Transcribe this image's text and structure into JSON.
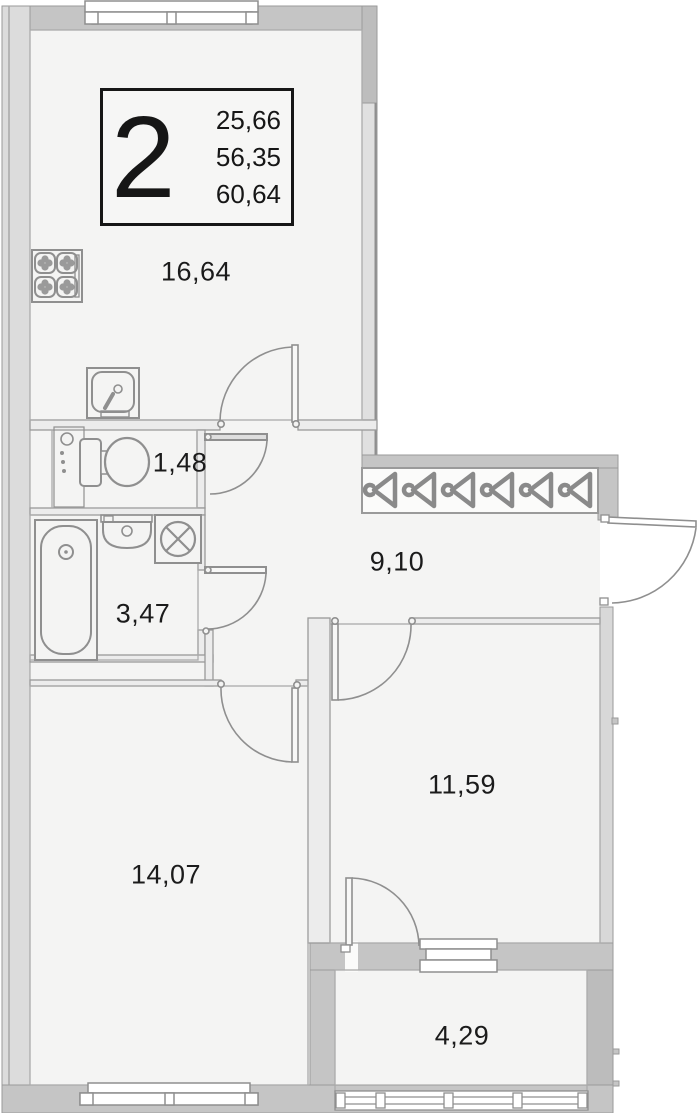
{
  "title_block": {
    "unit_number": "2",
    "area_values": [
      "25,66",
      "56,35",
      "60,64"
    ]
  },
  "rooms": [
    {
      "name": "kitchen",
      "area": "16,64"
    },
    {
      "name": "wc",
      "area": "1,48"
    },
    {
      "name": "bathroom",
      "area": "3,47"
    },
    {
      "name": "hallway",
      "area": "9,10"
    },
    {
      "name": "room-1",
      "area": "14,07"
    },
    {
      "name": "room-2",
      "area": "11,59"
    },
    {
      "name": "balcony",
      "area": "4,29"
    }
  ],
  "icons": [
    "stove-icon",
    "kitchen-sink-icon",
    "pipes-riser-icon",
    "toilet-icon",
    "bathtub-icon",
    "washbasin-icon",
    "washing-machine-icon",
    "window-icon",
    "balcony-glazing-icon",
    "glazed-panels-icon",
    "door-arc-icon"
  ],
  "colors": {
    "wall": "#c5c5c5",
    "wall_dark": "#bdbdbd",
    "wall_light": "#dcdcdc",
    "room_fill": "#f4f4f3",
    "line": "#8f8f8f",
    "text": "#1b1b1b",
    "background": "#ffffff"
  }
}
